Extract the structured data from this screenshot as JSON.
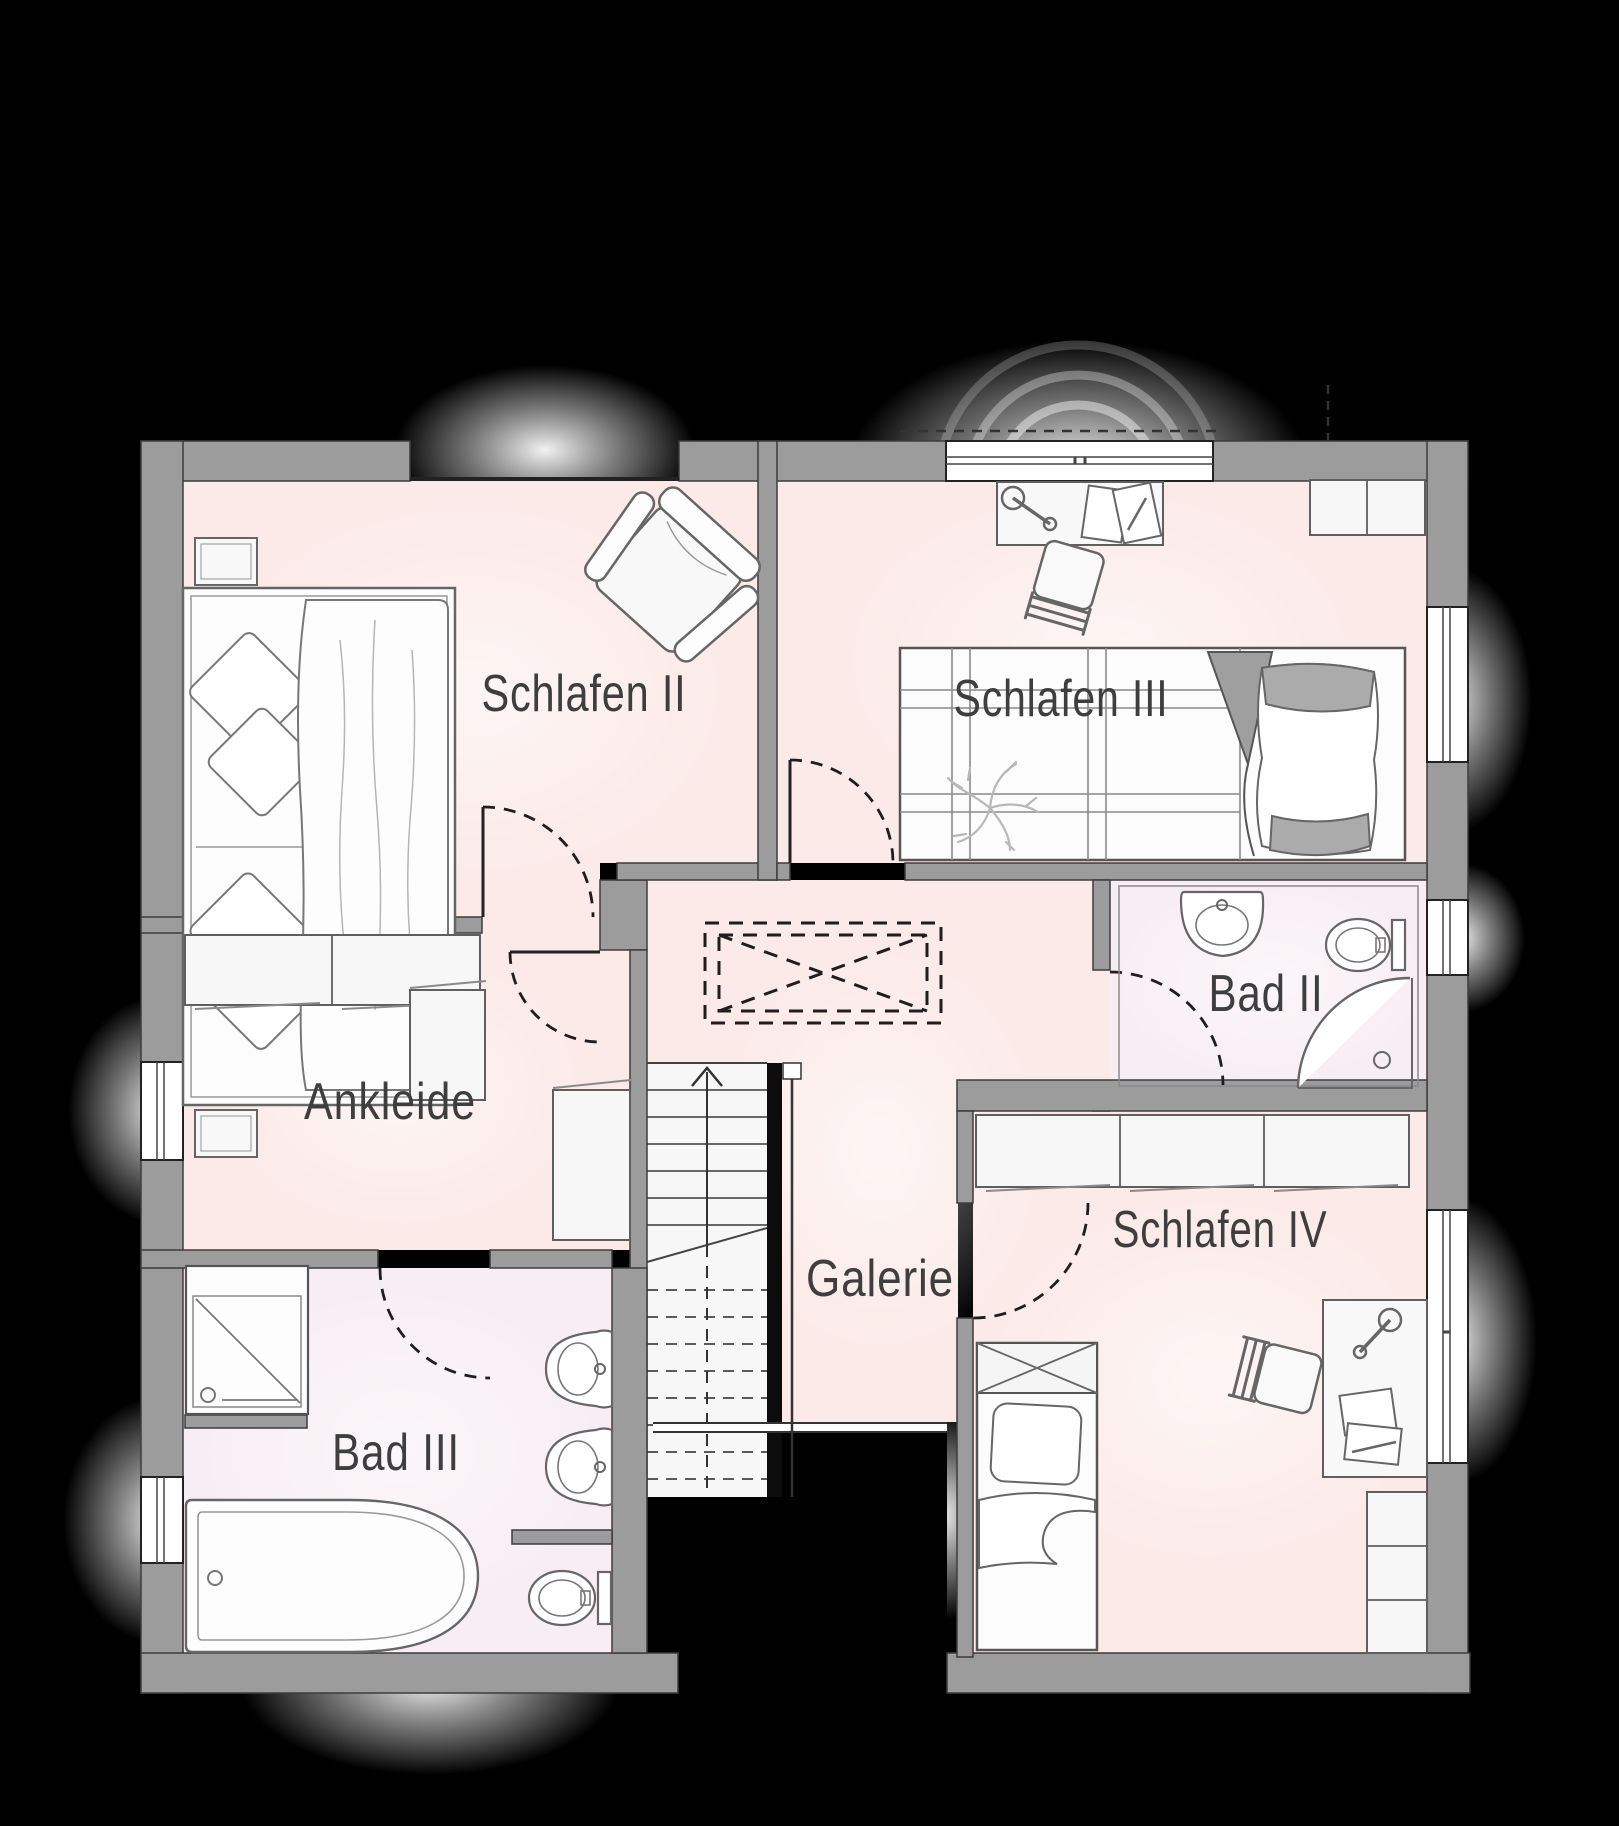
{
  "canvas": {
    "width": 1619,
    "height": 1826,
    "background": "#000000"
  },
  "colors": {
    "wall": "#9c9c9c",
    "wall_outline": "#3c3c3c",
    "floor": "#fbeae8",
    "floor_bath": "#f7eef3",
    "stairs": "#f7f7f7",
    "furniture_fill": "#f8f8f8",
    "furniture_stroke": "#5f5f5f",
    "door_dash": "#1e1e1e",
    "label": "#3e3e3e",
    "window": "#ffffff"
  },
  "rooms": [
    {
      "id": "schlafen-2",
      "label": "Schlafen II"
    },
    {
      "id": "schlafen-3",
      "label": "Schlafen III"
    },
    {
      "id": "bad-2",
      "label": "Bad II"
    },
    {
      "id": "ankleide",
      "label": "Ankleide"
    },
    {
      "id": "galerie",
      "label": "Galerie"
    },
    {
      "id": "schlafen-4",
      "label": "Schlafen IV"
    },
    {
      "id": "bad-3",
      "label": "Bad III"
    }
  ],
  "furniture": [
    {
      "room": "schlafen-2",
      "items": [
        "double-bed",
        "nightstand",
        "nightstand",
        "armchair"
      ]
    },
    {
      "room": "schlafen-3",
      "items": [
        "desk",
        "desk-lamp",
        "desk-chair",
        "single-bed",
        "wardrobe",
        "plant"
      ]
    },
    {
      "room": "bad-2",
      "items": [
        "washbasin",
        "toilet",
        "corner-shower"
      ]
    },
    {
      "room": "ankleide",
      "items": [
        "wardrobe-row",
        "cabinet",
        "cabinet"
      ]
    },
    {
      "room": "galerie",
      "items": [
        "staircase",
        "ceiling-opening",
        "railing"
      ]
    },
    {
      "room": "schlafen-4",
      "items": [
        "wardrobe-row",
        "single-bed",
        "desk",
        "desk-lamp",
        "desk-chair",
        "shelf"
      ]
    },
    {
      "room": "bad-3",
      "items": [
        "shower",
        "washbasin",
        "washbasin",
        "bathtub",
        "toilet"
      ]
    }
  ],
  "doors": [
    "schlafen-2-door",
    "ankleide-door",
    "schlafen-3-door",
    "bad-2-door",
    "schlafen-4-door",
    "bad-3-door"
  ],
  "windows_count": 6,
  "stairs": {
    "direction_arrow": "up",
    "solid_treads": 6,
    "dashed_treads": 8
  }
}
